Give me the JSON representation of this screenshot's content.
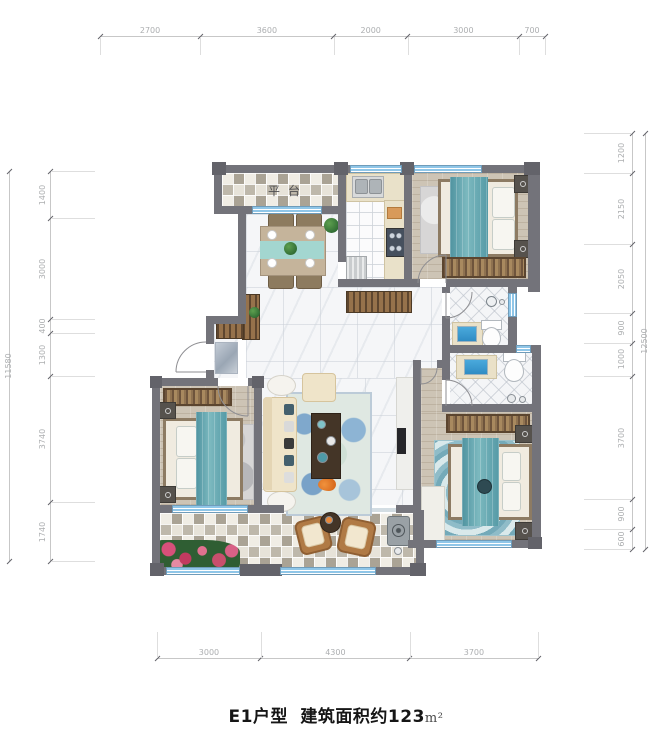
{
  "title": {
    "model": "E1户型",
    "area": "建筑面积约123",
    "unit": "m²"
  },
  "rooms": {
    "terrace": "平台"
  },
  "dimensions": {
    "top": {
      "values": [
        2700,
        3600,
        2000,
        3000,
        700
      ]
    },
    "bottom": {
      "values": [
        3000,
        4300,
        3700
      ]
    },
    "left": {
      "values": [
        1400,
        3000,
        400,
        1300,
        3740,
        1740
      ],
      "total": 11580
    },
    "right": {
      "values": [
        1200,
        2150,
        2050,
        900,
        1000,
        3700,
        900,
        600
      ],
      "total": 12500
    }
  },
  "colors": {
    "wall": "#73737a",
    "window_blue": "#8fc6e8",
    "teal_accent": "#569aa6",
    "wood_floor": "#cdc4b5",
    "dimension_text": "#acaeb0",
    "title_text": "#161616"
  }
}
